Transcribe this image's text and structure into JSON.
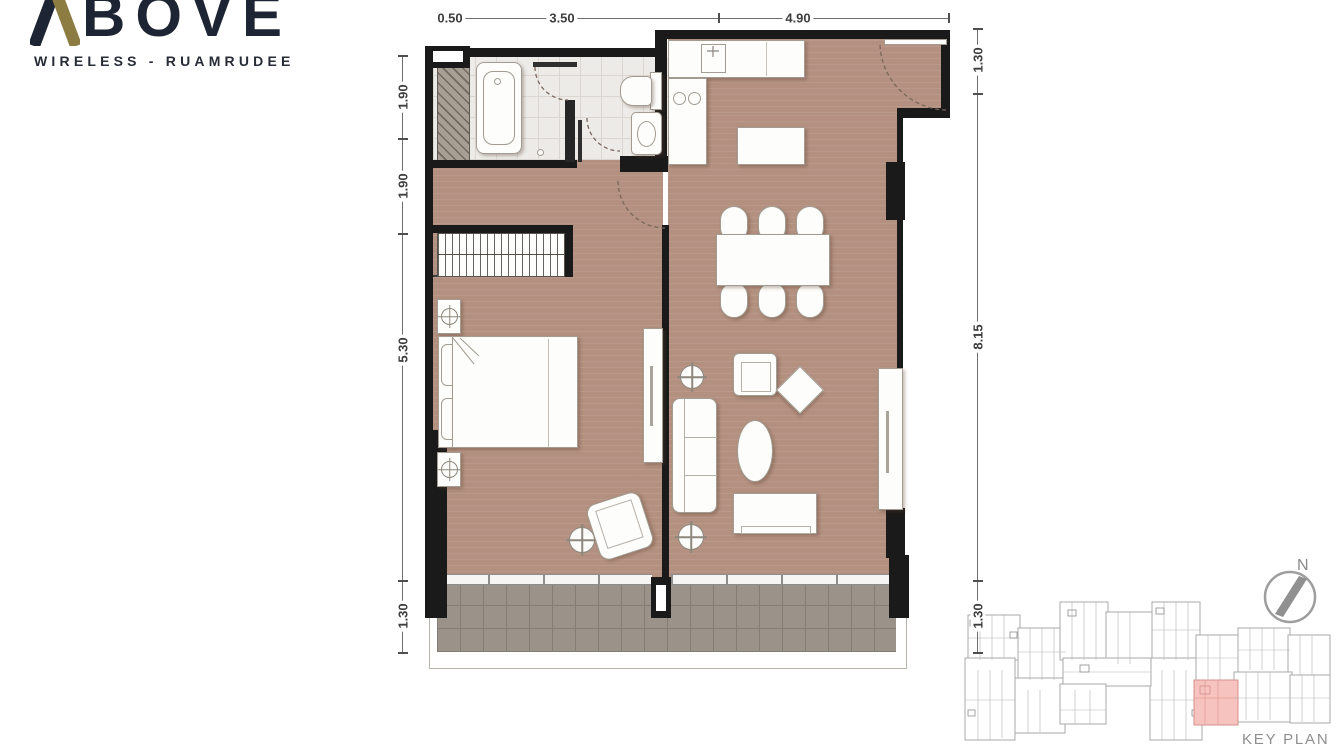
{
  "brand": {
    "name": "ABOVE",
    "name_rest": "BOVE",
    "tagline": "WIRELESS - RUAMRUDEE",
    "gold_color": "#8d7c42",
    "dark_color": "#1d2433"
  },
  "dimensions": {
    "top": [
      "0.50",
      "3.50",
      "4.90"
    ],
    "left": [
      "1.90",
      "1.90",
      "5.30",
      "1.30"
    ],
    "right": [
      "1.30",
      "8.15",
      "1.30"
    ]
  },
  "compass": {
    "label": "N"
  },
  "keyplan": {
    "label": "KEY PLAN",
    "highlight_color": "#f6c3be"
  },
  "colors": {
    "floor_wood": "#b3907f",
    "balcony_tile": "#9b9289",
    "bath_tile": "#edebe7",
    "wall": "#1a1a1a",
    "dimension_text": "#3e3e3e",
    "keyplan_line": "#a8a8a8"
  }
}
